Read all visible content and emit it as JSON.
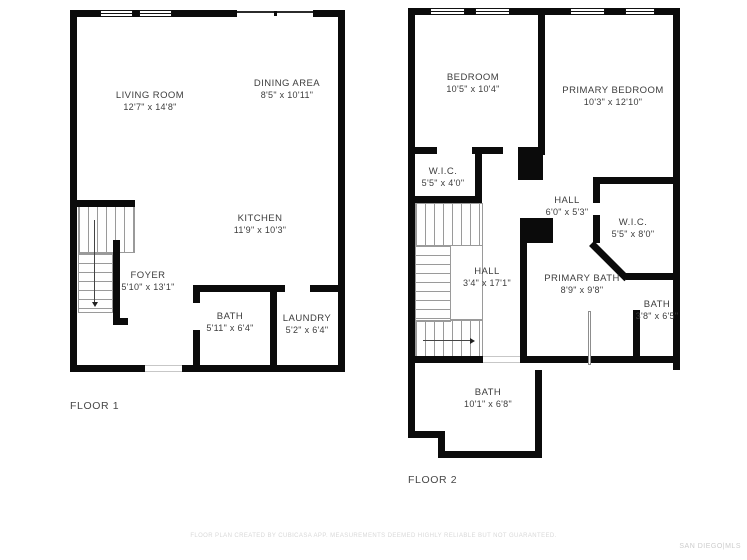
{
  "colors": {
    "wall": "#0b0b0b",
    "text": "#3d3d3d",
    "faint": "#d8d8d8"
  },
  "floor1": {
    "title": "FLOOR 1",
    "rooms": [
      {
        "name": "LIVING ROOM",
        "dims": "12'7\" x 14'8\""
      },
      {
        "name": "DINING AREA",
        "dims": "8'5\" x 10'11\""
      },
      {
        "name": "KITCHEN",
        "dims": "11'9\" x 10'3\""
      },
      {
        "name": "FOYER",
        "dims": "5'10\" x 13'1\""
      },
      {
        "name": "BATH",
        "dims": "5'11\" x 6'4\""
      },
      {
        "name": "LAUNDRY",
        "dims": "5'2\" x 6'4\""
      }
    ]
  },
  "floor2": {
    "title": "FLOOR 2",
    "rooms": [
      {
        "name": "BEDROOM",
        "dims": "10'5\" x 10'4\""
      },
      {
        "name": "PRIMARY BEDROOM",
        "dims": "10'3\" x 12'10\""
      },
      {
        "name": "W.I.C.",
        "dims": "5'5\" x 4'0\""
      },
      {
        "name": "HALL",
        "dims": "6'0\" x 5'3\""
      },
      {
        "name": "W.I.C.",
        "dims": "5'5\" x 8'0\""
      },
      {
        "name": "HALL",
        "dims": "3'4\" x 17'1\""
      },
      {
        "name": "PRIMARY BATH",
        "dims": "8'9\" x 9'8\""
      },
      {
        "name": "BATH",
        "dims": "3'8\" x 6'5\""
      },
      {
        "name": "BATH",
        "dims": "10'1\" x 6'8\""
      }
    ]
  },
  "footer": {
    "disclaimer": "FLOOR PLAN CREATED BY CUBICASA APP. MEASUREMENTS DEEMED HIGHLY RELIABLE BUT NOT GUARANTEED.",
    "brand": "SAN DIEGO|MLS"
  }
}
